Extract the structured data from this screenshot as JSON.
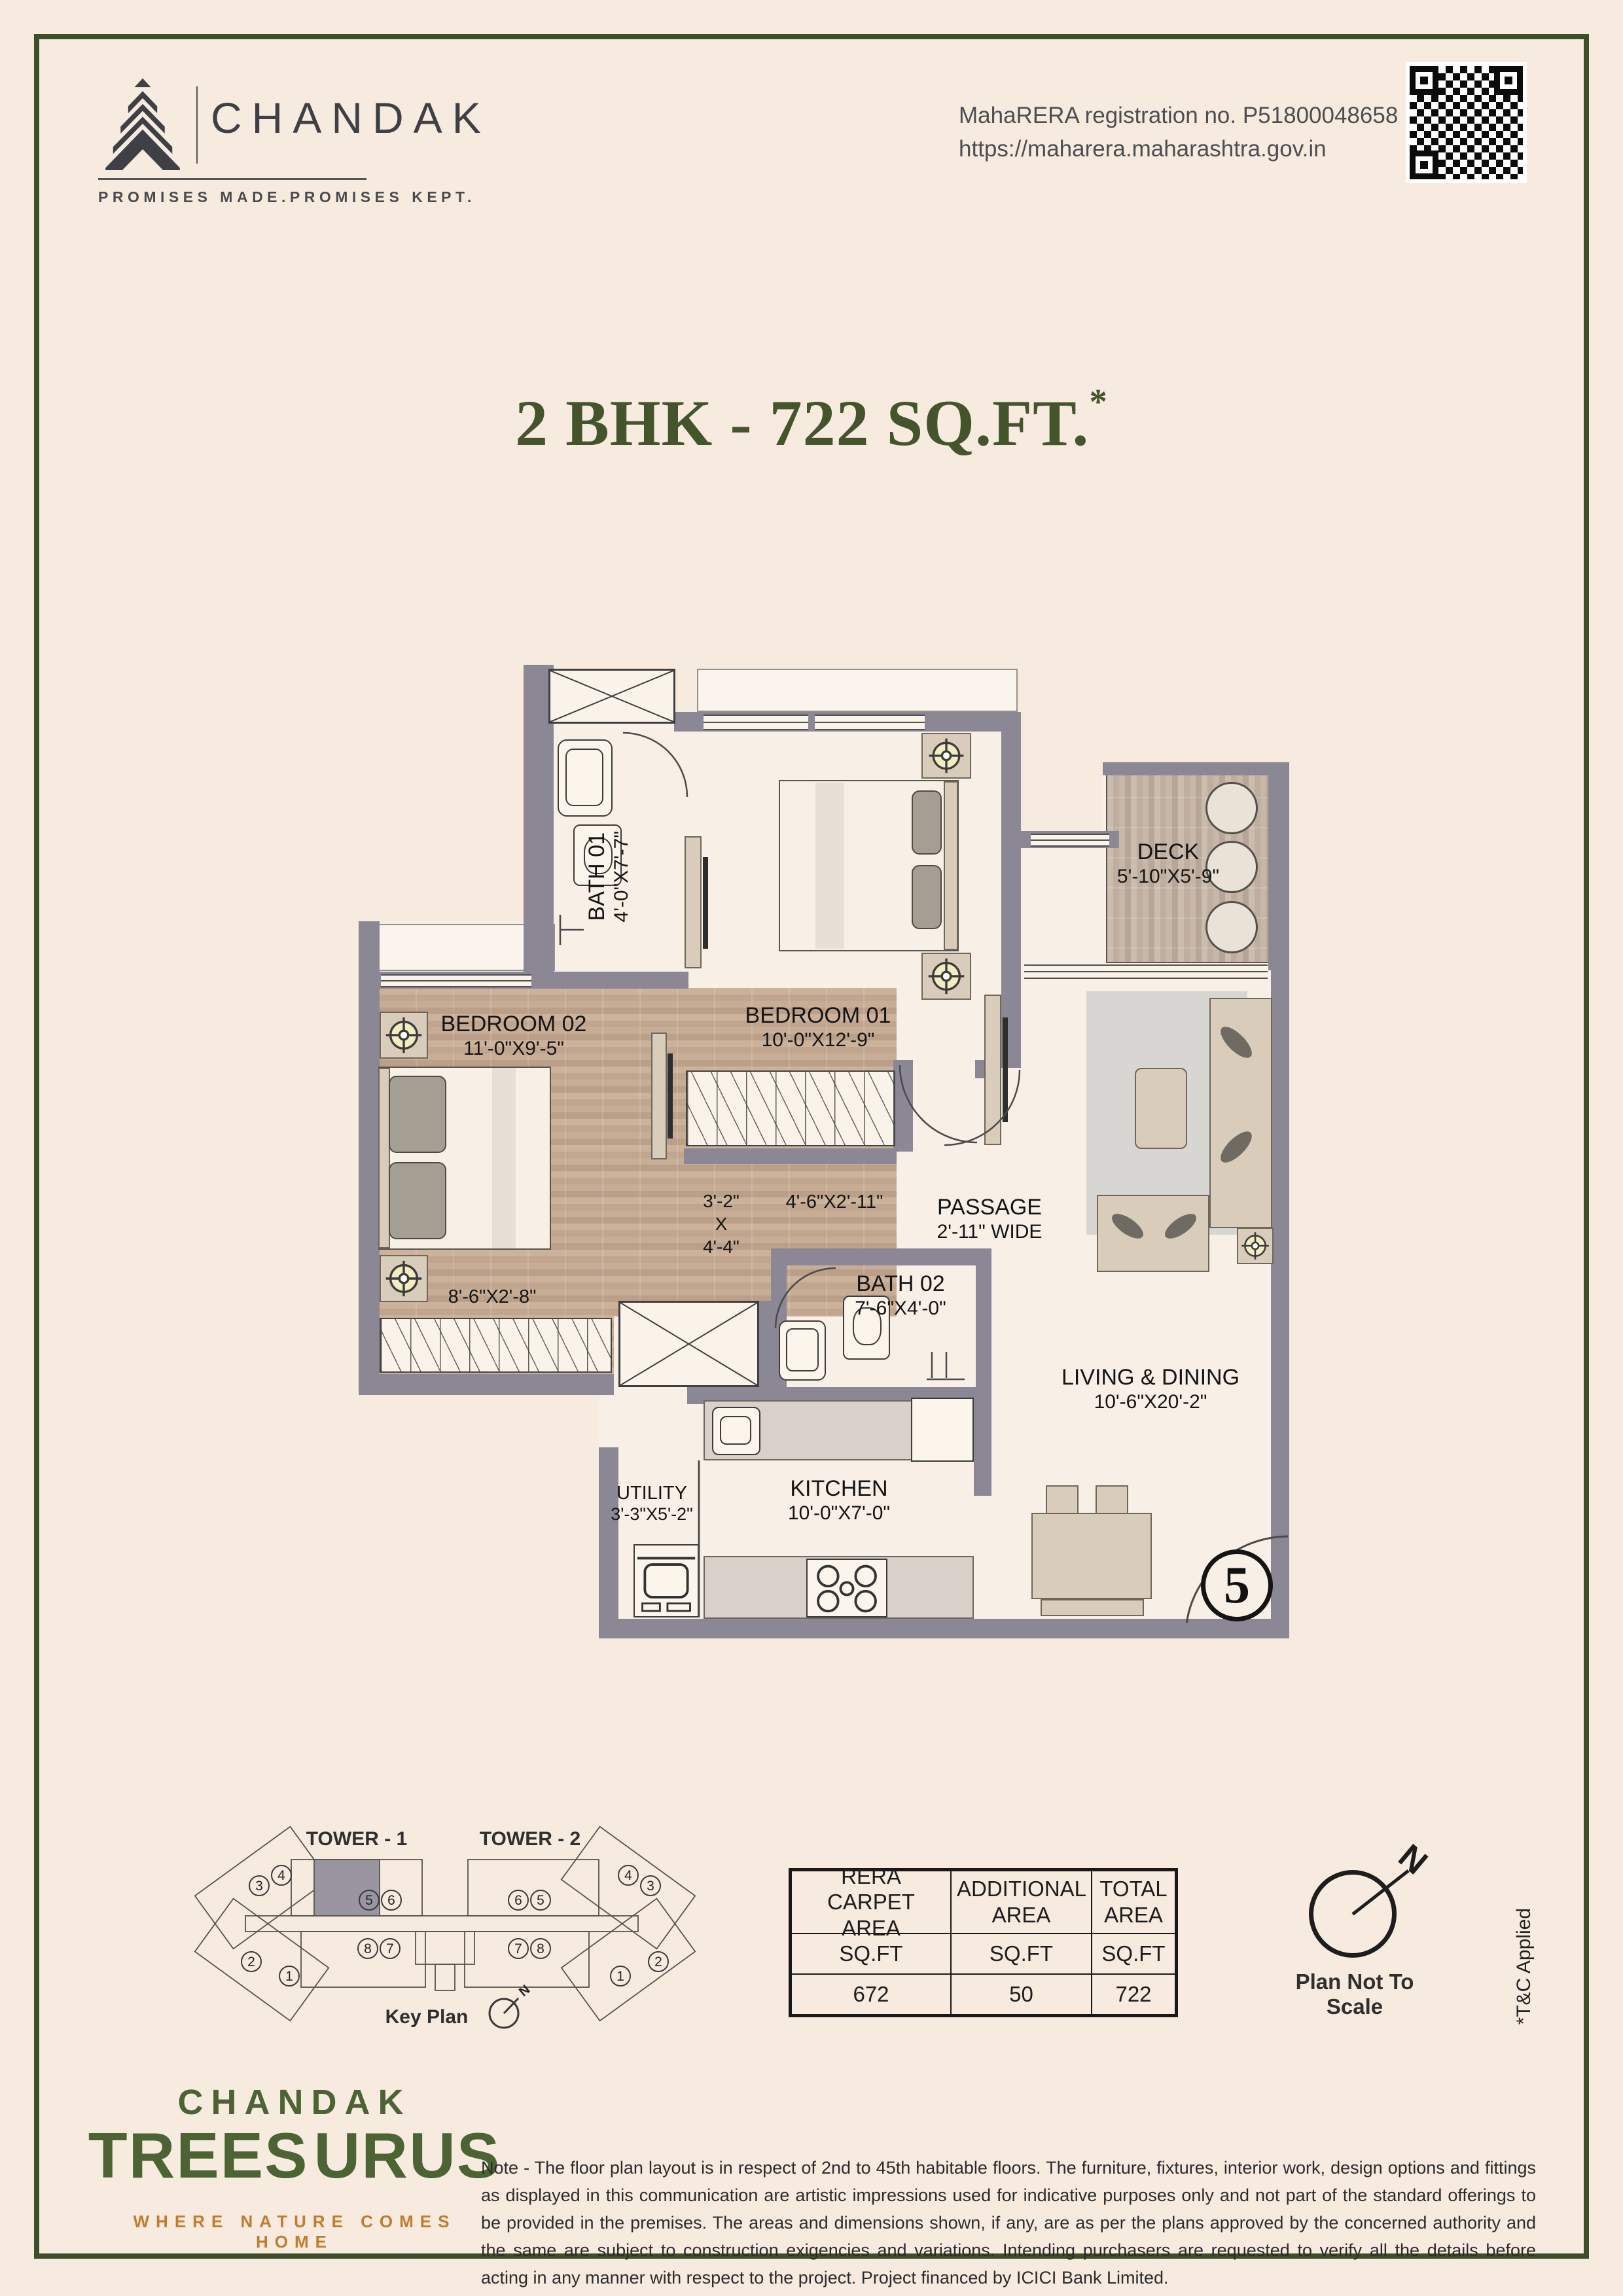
{
  "header": {
    "brand": "CHANDAK",
    "tagline": "PROMISES MADE.PROMISES KEPT.",
    "rera_line1": "MahaRERA registration no. P51800048658",
    "rera_line2": "https://maharera.maharashtra.gov.in"
  },
  "title": {
    "text": "2 BHK - 722 SQ.FT.",
    "asterisk": "*"
  },
  "plan": {
    "rooms": {
      "bath1": {
        "name": "BATH 01",
        "dim": "4'-0\"X7'-7\""
      },
      "bedroom1": {
        "name": "BEDROOM 01",
        "dim": "10'-0\"X12'-9\""
      },
      "deck": {
        "name": "DECK",
        "dim": "5'-10\"X5'-9\""
      },
      "bedroom2": {
        "name": "BEDROOM 02",
        "dim": "11'-0\"X9'-5\""
      },
      "passage": {
        "name": "PASSAGE",
        "dim": "2'-11\" WIDE"
      },
      "bath2": {
        "name": "BATH 02",
        "dim": "7'-6\"X4'-0\""
      },
      "living": {
        "name": "LIVING & DINING",
        "dim": "10'-6\"X20'-2\""
      },
      "kitchen": {
        "name": "KITCHEN",
        "dim": "10'-0\"X7'-0\""
      },
      "utility": {
        "name": "UTILITY",
        "dim": "3'-3\"X5'-2\""
      }
    },
    "dims": {
      "foyer_l1": "3'-2\"",
      "foyer_l2": "X",
      "foyer_l3": "4'-4\"",
      "wardrobe1": "4'-6\"X2'-11\"",
      "wardrobe2": "8'-6\"X2'-8\""
    },
    "unit_number": "5"
  },
  "keyplan": {
    "tower1_label": "TOWER - 1",
    "tower2_label": "TOWER - 2",
    "caption": "Key Plan",
    "north": "N",
    "t1": {
      "u3": "3",
      "u4": "4",
      "u5": "5",
      "u6": "6",
      "u8": "8",
      "u7": "7",
      "u2": "2",
      "u1": "1"
    },
    "t2": {
      "u6": "6",
      "u5": "5",
      "u4": "4",
      "u3": "3",
      "u7": "7",
      "u8": "8",
      "u1": "1",
      "u2": "2"
    }
  },
  "area_table": {
    "col1_header": "RERA CARPET AREA",
    "col2_header": "ADDITIONAL AREA",
    "col3_header": "TOTAL AREA",
    "unit": "SQ.FT",
    "col1_value": "672",
    "col2_value": "50",
    "col3_value": "722"
  },
  "compass": {
    "north": "N",
    "caption": "Plan Not To Scale"
  },
  "side_note": "*T&C Applied",
  "footer": {
    "brand_line1": "CHANDAK",
    "brand_line2_left": "TREES",
    "brand_line2_right": "URUS",
    "brand_tagline": "WHERE NATURE COMES HOME",
    "note": "Note - The floor plan layout is in respect of 2nd to 45th habitable floors. The furniture, fixtures, interior work, design options and fittings as displayed in this communication are artistic impressions used for indicative purposes only and not part of the standard offerings to be provided in the premises. The areas and dimensions shown, if any, are as per the plans approved by the concerned authority and the same are subject to construction exigencies and variations. Intending purchasers are requested to verify all the details before acting in any manner with respect to the project. Project financed by ICICI Bank Limited."
  }
}
